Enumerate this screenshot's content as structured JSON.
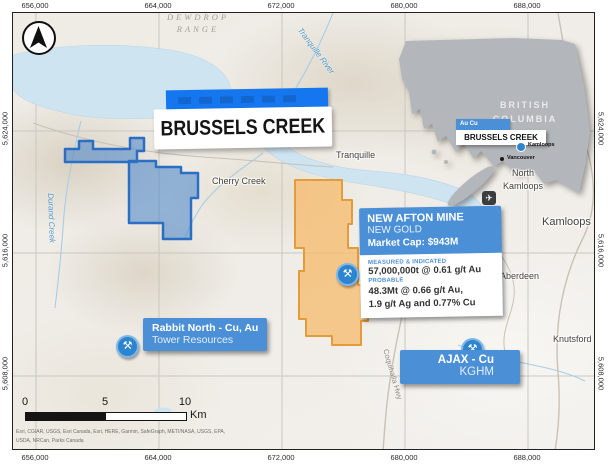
{
  "frame": {
    "grid_x": [
      "656,000",
      "664,000",
      "672,000",
      "680,000",
      "688,000"
    ],
    "grid_y": [
      "5,624,000",
      "5,616,000",
      "5,608,000"
    ]
  },
  "title_card": {
    "title": "BRUSSELS CREEK"
  },
  "places": {
    "dewdrop_line1": "DEWDROP",
    "dewdrop_line2": "RANGE",
    "tranquille_river": "Tranquille River",
    "durand_creek": "Durand Creek",
    "cherry_creek": "Cherry Creek",
    "tranquille": "Tranquille",
    "north_kamloops_line1": "North",
    "north_kamloops_line2": "Kamloops",
    "kamloops": "Kamloops",
    "aberdeen": "Aberdeen",
    "knutsford": "Knutsford",
    "coquihalla_hwy": "Coquihalla Hwy"
  },
  "inset": {
    "province_line1": "BRITISH",
    "province_line2": "COLUMBIA",
    "tag": "Au Cu",
    "label": "BRUSSELS CREEK",
    "city1": "Kamloops",
    "city2": "Vancouver"
  },
  "callouts": {
    "new_afton": {
      "title": "NEW AFTON MINE",
      "owner": "NEW GOLD",
      "market_cap": "Market Cap: $943M",
      "resource_class1": "MEASURED & INDICATED",
      "resource1": "57,000,000t @ 0.61 g/t Au",
      "resource_class2": "PROBABLE",
      "resource2_line1": "48.3Mt @ 0.66 g/t Au,",
      "resource2_line2": "1.9 g/t Ag and 0.77% Cu"
    },
    "rabbit_north": {
      "title": "Rabbit North - Cu, Au",
      "owner": "Tower Resources"
    },
    "ajax": {
      "title": "AJAX - Cu",
      "owner": "KGHM"
    }
  },
  "scalebar": {
    "tick0": "0",
    "tick1": "5",
    "tick2": "10",
    "unit": "Km"
  },
  "attribution_line1": "Esri, CGIAR, USGS, Esri Canada, Esri, HERE, Garmin, SafeGraph, METI/NASA, USGS, EPA,",
  "attribution_line2": "USDA, NRCan, Parks Canada",
  "icons": {
    "mine": "⚒",
    "airplane": "✈"
  },
  "colors": {
    "callout_blue": "#4b90d6",
    "title_blue": "#1577f0",
    "claim_blue_fill": "rgba(70,130,200,0.55)",
    "claim_blue_stroke": "#2b6fc4",
    "claim_orange_fill": "rgba(245,185,105,0.75)",
    "claim_orange_stroke": "#e39c3c",
    "inset_gray": "#b3b6ba",
    "water": "#cfe4f1"
  }
}
